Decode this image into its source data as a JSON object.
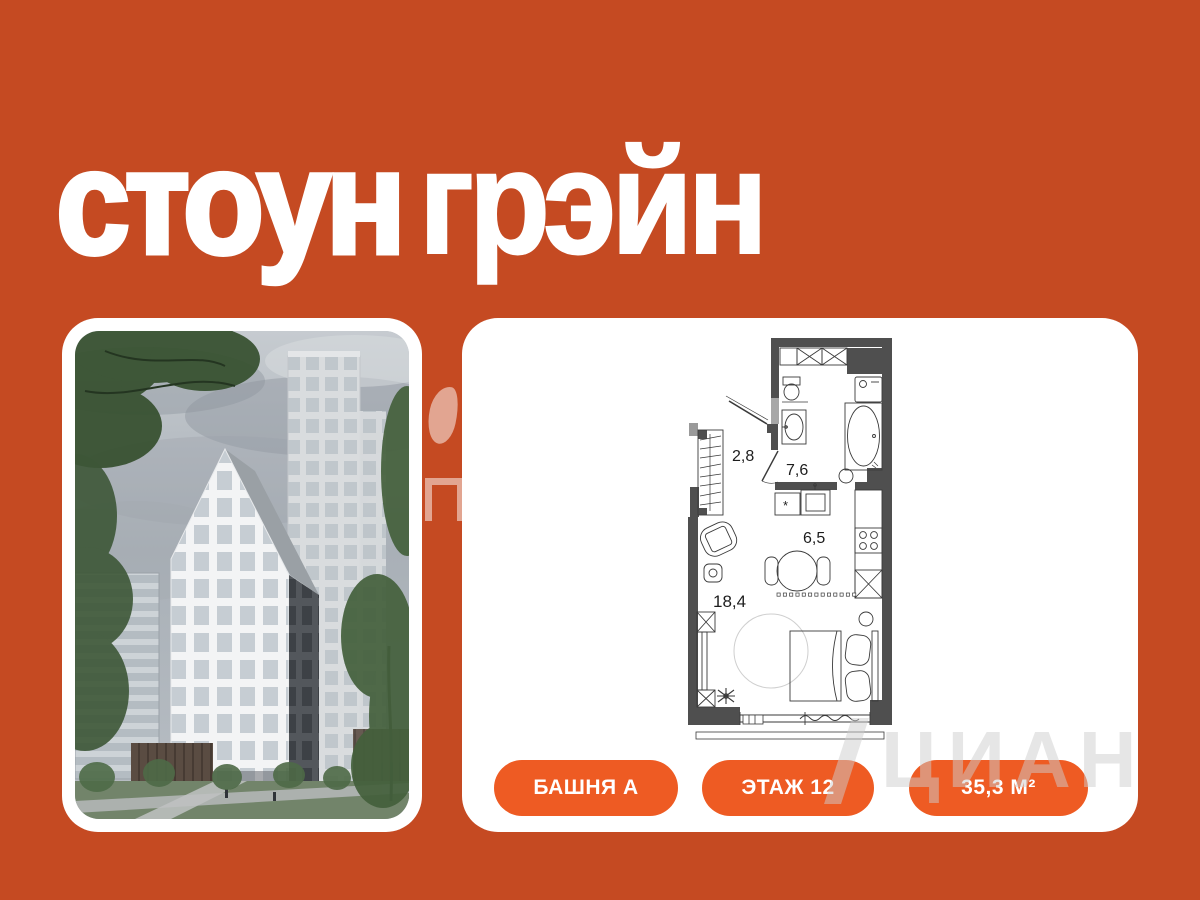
{
  "page": {
    "background_color": "#C54A22",
    "accent_color": "#EE5B23"
  },
  "brand": {
    "logo": {
      "word1": "стоун",
      "word2": "грэйн",
      "color": "#FFFFFF"
    }
  },
  "photo_card": {
    "description": "residential tower render with gabled white high-rise, rear tower, trees and lawn"
  },
  "plan_card": {
    "floor_plan": {
      "rooms": [
        {
          "id": "hallway",
          "area_label": "2,8"
        },
        {
          "id": "bathroom",
          "area_label": "7,6"
        },
        {
          "id": "kitchen",
          "area_label": "6,5"
        },
        {
          "id": "living-room",
          "area_label": "18,4"
        }
      ]
    },
    "badges": [
      {
        "label": "БАШНЯ А"
      },
      {
        "label": "ЭТАЖ 12"
      },
      {
        "label": "35,3 М²"
      }
    ]
  },
  "watermark": {
    "text": "ЦИАН"
  }
}
